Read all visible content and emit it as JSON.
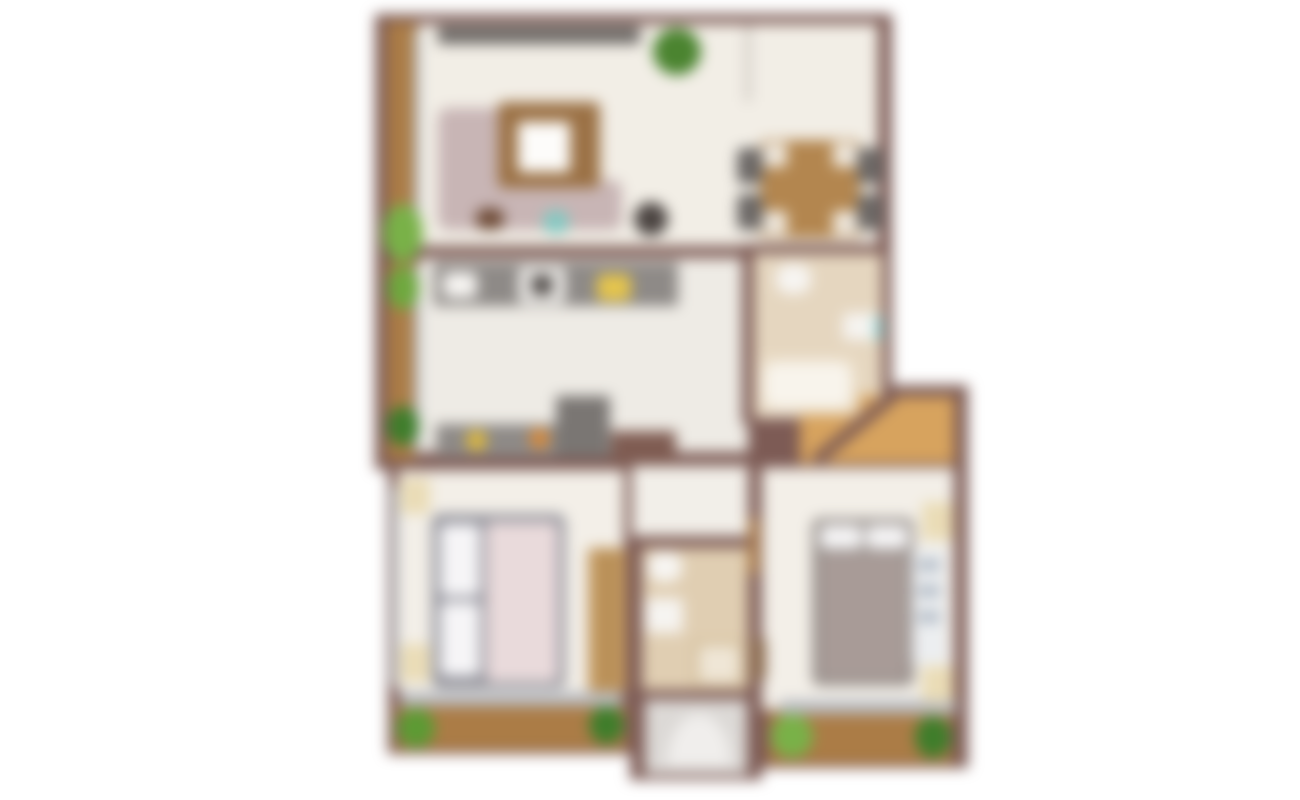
{
  "plan": {
    "description": "blurred top-down apartment floor plan",
    "canvas": {
      "width": 1300,
      "height": 800,
      "background": "#ffffff"
    },
    "blur_px": 7,
    "palette": {
      "wall": "#7d5b55",
      "balcony_wood": "#ab7c46",
      "hall_wood": "#d7a35e",
      "floor_cream": "#f2eee6",
      "floor_kitchen": "#eeebe5",
      "floor_bath": "#e5d6bf",
      "floor_bath2": "#e0ceb2",
      "floor_entry": "#dcd9d6",
      "counter_gray": "#8e8a87",
      "window_gray": "#b9bcc2",
      "plant_green": "#79b148",
      "plant_dark_green": "#3f7d2b",
      "sofa_mauve": "#c8b5b5",
      "bed_taupe": "#a89b97",
      "bed_pink": "#e9dadb",
      "nightstand_cream": "#eadcb6"
    },
    "rooms": [
      {
        "name": "living-room"
      },
      {
        "name": "dining-area"
      },
      {
        "name": "kitchen"
      },
      {
        "name": "bathroom-1"
      },
      {
        "name": "hall"
      },
      {
        "name": "corridor"
      },
      {
        "name": "bedroom-1"
      },
      {
        "name": "bathroom-2"
      },
      {
        "name": "entry-stairwell"
      },
      {
        "name": "bedroom-2"
      },
      {
        "name": "balcony-left"
      },
      {
        "name": "balcony-bottom-left"
      },
      {
        "name": "balcony-bottom-right"
      }
    ],
    "elements": [
      {
        "name": "wall-block-upper",
        "x": 375,
        "y": 14,
        "w": 517,
        "h": 456,
        "fill": "#7d5b55"
      },
      {
        "name": "wall-block-lower-left",
        "x": 388,
        "y": 458,
        "w": 244,
        "h": 296,
        "fill": "#7d5b55"
      },
      {
        "name": "wall-block-lower-middle",
        "x": 630,
        "y": 458,
        "w": 132,
        "h": 322,
        "fill": "#7d5b55"
      },
      {
        "name": "wall-block-lower-right",
        "x": 750,
        "y": 385,
        "w": 218,
        "h": 383,
        "fill": "#7d5b55"
      },
      {
        "name": "balcony-living-floor",
        "x": 387,
        "y": 22,
        "w": 30,
        "h": 232,
        "fill": "#ab7c46"
      },
      {
        "name": "balcony-kitchen-floor",
        "x": 387,
        "y": 262,
        "w": 30,
        "h": 198,
        "fill": "#ab7c46"
      },
      {
        "name": "living-dining-floor",
        "x": 418,
        "y": 24,
        "w": 460,
        "h": 224,
        "fill": "#f2eee6"
      },
      {
        "name": "kitchen-corridor-floor",
        "x": 418,
        "y": 258,
        "w": 330,
        "h": 196,
        "fill": "#eeebe5"
      },
      {
        "name": "bathroom1-floor",
        "x": 754,
        "y": 252,
        "w": 128,
        "h": 166,
        "fill": "#e5d6bf"
      },
      {
        "name": "hall-floor",
        "x": 800,
        "y": 395,
        "w": 154,
        "h": 68,
        "fill": "#d7a35e"
      },
      {
        "name": "corridor-floor",
        "x": 632,
        "y": 454,
        "w": 126,
        "h": 92,
        "fill": "#f2efe9"
      },
      {
        "name": "bedroom1-floor",
        "x": 398,
        "y": 470,
        "w": 226,
        "h": 222,
        "fill": "#f3efe8"
      },
      {
        "name": "bathroom2-floor",
        "x": 642,
        "y": 548,
        "w": 106,
        "h": 142,
        "fill": "#e0ceb2"
      },
      {
        "name": "entry-floor",
        "x": 645,
        "y": 700,
        "w": 102,
        "h": 74,
        "fill": "#dcd9d6"
      },
      {
        "name": "bedroom2-floor",
        "x": 762,
        "y": 468,
        "w": 192,
        "h": 242,
        "fill": "#f3efe8"
      },
      {
        "name": "balcony1-floor",
        "x": 396,
        "y": 706,
        "w": 230,
        "h": 44,
        "fill": "#ab7c46"
      },
      {
        "name": "balcony2-floor",
        "x": 768,
        "y": 712,
        "w": 184,
        "h": 52,
        "fill": "#ab7c46"
      },
      {
        "name": "wall-living-kitchen",
        "x": 418,
        "y": 246,
        "w": 330,
        "h": 12,
        "fill": "#7d5b55"
      },
      {
        "name": "wall-corridor-bathroom1",
        "x": 742,
        "y": 252,
        "w": 12,
        "h": 172,
        "fill": "#7d5b55"
      },
      {
        "name": "wall-dining-bathroom1",
        "x": 742,
        "y": 244,
        "w": 150,
        "h": 10,
        "fill": "#7d5b55"
      },
      {
        "name": "wall-kitchen-bottom",
        "x": 418,
        "y": 452,
        "w": 332,
        "h": 14,
        "fill": "#7d5b55"
      },
      {
        "name": "wall-hall-top",
        "x": 884,
        "y": 385,
        "w": 84,
        "h": 12,
        "fill": "#7d5b55"
      },
      {
        "name": "wall-bathroom1-hall-diagonal",
        "x": 812,
        "y": 456,
        "w": 102,
        "h": 12,
        "fill": "#7d5b55",
        "rotate": -40
      },
      {
        "name": "wall-corridor-bedroom2",
        "x": 748,
        "y": 454,
        "w": 12,
        "h": 94,
        "fill": "#7d5b55"
      },
      {
        "name": "wall-bathroom2-top",
        "x": 632,
        "y": 536,
        "w": 128,
        "h": 12,
        "fill": "#7d5b55"
      },
      {
        "name": "wall-balcony-divider",
        "x": 383,
        "y": 250,
        "w": 38,
        "h": 12,
        "fill": "#7d5b55"
      },
      {
        "name": "wall-stub-living-dining",
        "x": 745,
        "y": 24,
        "w": 6,
        "h": 78,
        "fill": "#cfc9c2"
      },
      {
        "name": "window-living-left",
        "x": 414,
        "y": 30,
        "w": 6,
        "h": 214,
        "fill": "#b7bec6"
      },
      {
        "name": "window-kitchen-left",
        "x": 414,
        "y": 266,
        "w": 6,
        "h": 188,
        "fill": "#b7bec6"
      },
      {
        "name": "window-bedroom1-left",
        "x": 392,
        "y": 486,
        "w": 6,
        "h": 200,
        "fill": "#b7bec6"
      },
      {
        "name": "window-bedroom1-bottom",
        "x": 400,
        "y": 692,
        "w": 222,
        "h": 14,
        "fill": "#b9bcc2"
      },
      {
        "name": "window-bedroom2-bottom",
        "x": 780,
        "y": 700,
        "w": 176,
        "h": 14,
        "fill": "#b9bcc2"
      },
      {
        "name": "tv-console",
        "x": 438,
        "y": 26,
        "w": 202,
        "h": 18,
        "fill": "#6e6a67"
      },
      {
        "name": "plant-living",
        "x": 653,
        "y": 28,
        "w": 48,
        "h": 47,
        "fill": "#4b8430",
        "radius": "50%"
      },
      {
        "name": "sofa-chaise",
        "x": 438,
        "y": 108,
        "w": 98,
        "h": 120,
        "fill": "#c8b5b5",
        "radius": "10px"
      },
      {
        "name": "sofa-seat",
        "x": 438,
        "y": 180,
        "w": 184,
        "h": 50,
        "fill": "#c8b5b5",
        "radius": "10px"
      },
      {
        "name": "coffee-table",
        "x": 498,
        "y": 102,
        "w": 102,
        "h": 86,
        "fill": "#9b7145",
        "radius": "6px"
      },
      {
        "name": "coffee-table-top",
        "x": 518,
        "y": 122,
        "w": 52,
        "h": 50,
        "fill": "#fdfcfa",
        "radius": "4px"
      },
      {
        "name": "side-table",
        "x": 634,
        "y": 202,
        "w": 34,
        "h": 34,
        "fill": "#4c4542",
        "radius": "50%"
      },
      {
        "name": "decor-teal",
        "x": 543,
        "y": 210,
        "w": 26,
        "h": 24,
        "fill": "#86c8c2",
        "radius": "40%"
      },
      {
        "name": "decor-brown",
        "x": 476,
        "y": 208,
        "w": 28,
        "h": 22,
        "fill": "#6f4c38",
        "radius": "40%"
      },
      {
        "name": "dining-table",
        "x": 760,
        "y": 140,
        "w": 100,
        "h": 98,
        "fill": "#b3864f",
        "radius": "6px"
      },
      {
        "name": "dining-table-corner",
        "x": 763,
        "y": 143,
        "w": 24,
        "h": 24,
        "fill": "#efe8dd",
        "radius": "4px"
      },
      {
        "name": "dining-table-corner",
        "x": 833,
        "y": 143,
        "w": 24,
        "h": 24,
        "fill": "#efe8dd",
        "radius": "4px"
      },
      {
        "name": "dining-table-corner",
        "x": 763,
        "y": 211,
        "w": 24,
        "h": 24,
        "fill": "#efe8dd",
        "radius": "4px"
      },
      {
        "name": "dining-table-corner",
        "x": 833,
        "y": 211,
        "w": 24,
        "h": 24,
        "fill": "#efe8dd",
        "radius": "4px"
      },
      {
        "name": "dining-chair",
        "x": 737,
        "y": 148,
        "w": 26,
        "h": 36,
        "fill": "#6c6866",
        "radius": "6px"
      },
      {
        "name": "dining-chair",
        "x": 737,
        "y": 194,
        "w": 26,
        "h": 36,
        "fill": "#6c6866",
        "radius": "6px"
      },
      {
        "name": "dining-chair",
        "x": 857,
        "y": 148,
        "w": 26,
        "h": 36,
        "fill": "#6c6866",
        "radius": "6px"
      },
      {
        "name": "dining-chair",
        "x": 857,
        "y": 194,
        "w": 26,
        "h": 36,
        "fill": "#6c6866",
        "radius": "6px"
      },
      {
        "name": "kitchen-counter-top",
        "x": 434,
        "y": 262,
        "w": 244,
        "h": 44,
        "fill": "#8e8a87"
      },
      {
        "name": "kitchen-sink",
        "x": 443,
        "y": 272,
        "w": 34,
        "h": 26,
        "fill": "#f6f4f1",
        "radius": "6px"
      },
      {
        "name": "stove",
        "x": 519,
        "y": 267,
        "w": 46,
        "h": 36,
        "fill": "#f2f0ed",
        "radius": "4px"
      },
      {
        "name": "stove-cooktop",
        "x": 531,
        "y": 275,
        "w": 22,
        "h": 20,
        "fill": "#55504d",
        "radius": "4px"
      },
      {
        "name": "counter-item-yellow",
        "x": 597,
        "y": 274,
        "w": 34,
        "h": 27,
        "fill": "#e5c54d",
        "radius": "6px"
      },
      {
        "name": "kitchen-counter-bottom",
        "x": 436,
        "y": 424,
        "w": 166,
        "h": 33,
        "fill": "#8e8a87"
      },
      {
        "name": "counter-item-yellow-small",
        "x": 466,
        "y": 430,
        "w": 21,
        "h": 21,
        "fill": "#ddb83e",
        "radius": "50%"
      },
      {
        "name": "counter-item-orange",
        "x": 529,
        "y": 428,
        "w": 21,
        "h": 21,
        "fill": "#d68a3c",
        "radius": "50%"
      },
      {
        "name": "fridge",
        "x": 556,
        "y": 396,
        "w": 54,
        "h": 61,
        "fill": "#7a7673"
      },
      {
        "name": "kitchen-cabinet",
        "x": 611,
        "y": 431,
        "w": 65,
        "h": 31,
        "fill": "#7f5c52"
      },
      {
        "name": "toilet-bathroom1",
        "x": 776,
        "y": 264,
        "w": 35,
        "h": 30,
        "fill": "#f7f5f2",
        "radius": "40%"
      },
      {
        "name": "sink-bathroom1",
        "x": 843,
        "y": 313,
        "w": 39,
        "h": 27,
        "fill": "#f6f4f1",
        "radius": "4px"
      },
      {
        "name": "shower-accent",
        "x": 874,
        "y": 316,
        "w": 9,
        "h": 24,
        "fill": "#9ed6d3"
      },
      {
        "name": "bathtub",
        "x": 756,
        "y": 355,
        "w": 103,
        "h": 60,
        "fill": "#eadcc6",
        "radius": "8px"
      },
      {
        "name": "bathtub-inner",
        "x": 764,
        "y": 362,
        "w": 87,
        "h": 46,
        "fill": "#f8f4ec",
        "radius": "12px"
      },
      {
        "name": "door-bedroom2",
        "x": 748,
        "y": 518,
        "w": 11,
        "h": 56,
        "fill": "#a97a4a"
      },
      {
        "name": "bed1-frame",
        "x": 432,
        "y": 514,
        "w": 133,
        "h": 174,
        "fill": "#8f8f98",
        "radius": "8px"
      },
      {
        "name": "bed1-pillow",
        "x": 440,
        "y": 524,
        "w": 40,
        "h": 72,
        "fill": "#f6f5f7",
        "radius": "6px"
      },
      {
        "name": "bed1-pillow",
        "x": 440,
        "y": 602,
        "w": 40,
        "h": 74,
        "fill": "#f6f5f7",
        "radius": "6px"
      },
      {
        "name": "bed1-duvet",
        "x": 486,
        "y": 522,
        "w": 72,
        "h": 160,
        "fill": "#e9dadb",
        "radius": "6px"
      },
      {
        "name": "nightstand-bedroom1",
        "x": 400,
        "y": 478,
        "w": 30,
        "h": 36,
        "fill": "#eadcb6",
        "radius": "4px"
      },
      {
        "name": "nightstand-bedroom1",
        "x": 400,
        "y": 644,
        "w": 30,
        "h": 38,
        "fill": "#eadcb6",
        "radius": "4px"
      },
      {
        "name": "wardrobe-bedroom1",
        "x": 588,
        "y": 548,
        "w": 38,
        "h": 144,
        "fill": "#c1975e",
        "radius": "4px"
      },
      {
        "name": "wardrobe-line",
        "x": 606,
        "y": 552,
        "w": 3,
        "h": 136,
        "fill": "#9a7442"
      },
      {
        "name": "toilet-bathroom2",
        "x": 648,
        "y": 552,
        "w": 34,
        "h": 30,
        "fill": "#f7f5f2",
        "radius": "40%"
      },
      {
        "name": "sink-bathroom2",
        "x": 645,
        "y": 598,
        "w": 38,
        "h": 35,
        "fill": "#f6f4f1",
        "radius": "4px"
      },
      {
        "name": "shower-bathroom2",
        "x": 692,
        "y": 640,
        "w": 54,
        "h": 48,
        "fill": "#d6c2a0",
        "radius": "4px"
      },
      {
        "name": "shower-inner",
        "x": 699,
        "y": 646,
        "w": 40,
        "h": 36,
        "fill": "#efe6d6",
        "radius": "4px"
      },
      {
        "name": "entry-door-swing-arc",
        "x": 667,
        "y": 714,
        "w": 64,
        "h": 52,
        "fill": "#f0eeec",
        "radius": "50% 50% 0 0 / 100% 100% 0 0"
      },
      {
        "name": "bed2-frame",
        "x": 812,
        "y": 518,
        "w": 102,
        "h": 168,
        "fill": "#99928e",
        "radius": "8px"
      },
      {
        "name": "bed2-pillow",
        "x": 820,
        "y": 525,
        "w": 42,
        "h": 24,
        "fill": "#f5f4f5",
        "radius": "6px"
      },
      {
        "name": "bed2-pillow",
        "x": 866,
        "y": 525,
        "w": 42,
        "h": 24,
        "fill": "#f5f4f5",
        "radius": "6px"
      },
      {
        "name": "bed2-duvet",
        "x": 820,
        "y": 553,
        "w": 86,
        "h": 126,
        "fill": "#a89b97",
        "radius": "6px"
      },
      {
        "name": "dresser-bedroom2",
        "x": 912,
        "y": 548,
        "w": 34,
        "h": 116,
        "fill": "#eceef0",
        "radius": "4px"
      },
      {
        "name": "dresser-drawer",
        "x": 918,
        "y": 560,
        "w": 22,
        "h": 10,
        "fill": "#a9b3bf"
      },
      {
        "name": "dresser-drawer",
        "x": 918,
        "y": 586,
        "w": 22,
        "h": 10,
        "fill": "#a9b3bf"
      },
      {
        "name": "dresser-drawer",
        "x": 918,
        "y": 612,
        "w": 22,
        "h": 10,
        "fill": "#a9b3bf"
      },
      {
        "name": "nightstand-bedroom2",
        "x": 922,
        "y": 502,
        "w": 32,
        "h": 38,
        "fill": "#eadcb6",
        "radius": "4px"
      },
      {
        "name": "nightstand-bedroom2",
        "x": 922,
        "y": 666,
        "w": 32,
        "h": 36,
        "fill": "#eadcb6",
        "radius": "4px"
      },
      {
        "name": "radiator-bedroom2",
        "x": 752,
        "y": 638,
        "w": 14,
        "h": 42,
        "fill": "#8a6a4e",
        "radius": "4px"
      },
      {
        "name": "plant-balcony-living",
        "x": 383,
        "y": 204,
        "w": 40,
        "h": 58,
        "fill": "#79b148",
        "radius": "50%"
      },
      {
        "name": "plant-balcony-kitchen",
        "x": 387,
        "y": 266,
        "w": 32,
        "h": 44,
        "fill": "#6fa83e",
        "radius": "50%"
      },
      {
        "name": "plant-balcony-kitchen",
        "x": 387,
        "y": 406,
        "w": 32,
        "h": 40,
        "fill": "#3f7d2b",
        "radius": "50%"
      },
      {
        "name": "plant-balcony1-left",
        "x": 397,
        "y": 708,
        "w": 38,
        "h": 40,
        "fill": "#5d9a34",
        "radius": "50%"
      },
      {
        "name": "plant-balcony1-right",
        "x": 589,
        "y": 706,
        "w": 35,
        "h": 38,
        "fill": "#3f7d2b",
        "radius": "50%"
      },
      {
        "name": "plant-balcony2-left",
        "x": 771,
        "y": 714,
        "w": 42,
        "h": 44,
        "fill": "#79b148",
        "radius": "50%"
      },
      {
        "name": "plant-balcony2-right",
        "x": 915,
        "y": 716,
        "w": 36,
        "h": 42,
        "fill": "#3f7d2b",
        "radius": "50%"
      }
    ]
  }
}
